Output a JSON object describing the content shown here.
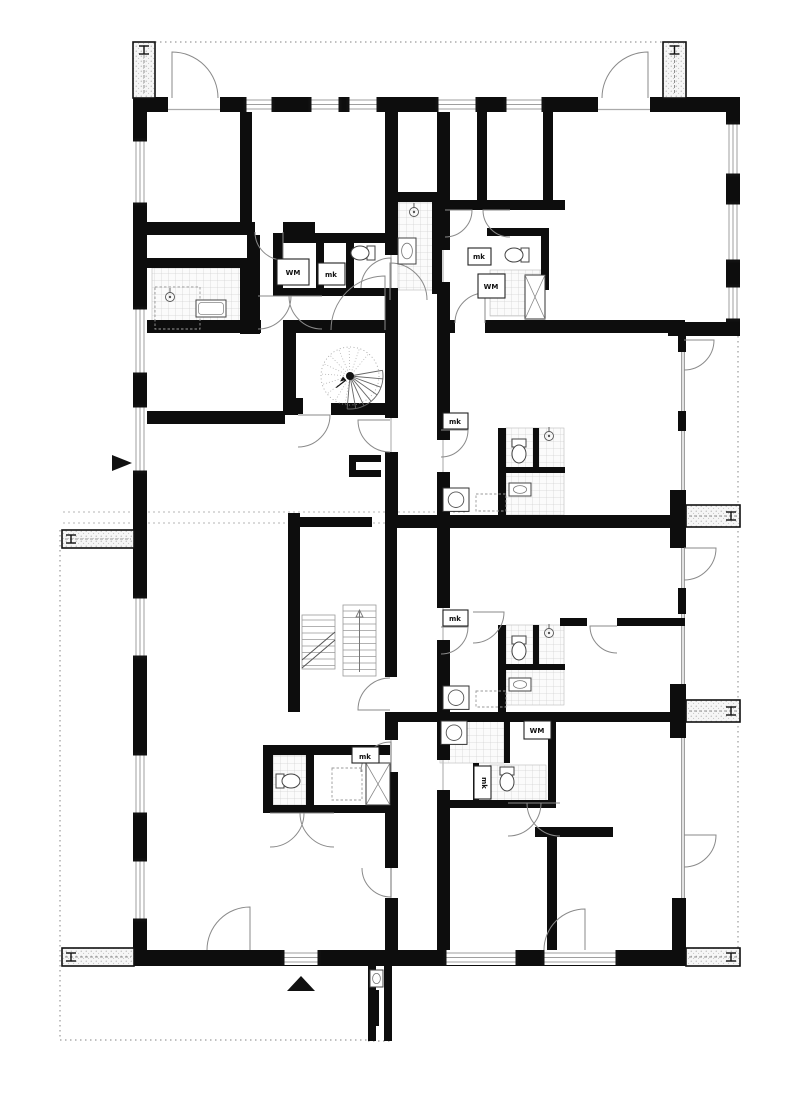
{
  "meta": {
    "drawing_type": "architectural floor plan",
    "bg_color": "#ffffff",
    "wall_color": "#0d0d0d",
    "thin_color": "#8a8a8a",
    "tile_line_color": "#c9c9c9",
    "tile_fill": "#fbfbfb",
    "dotted_color": "#9a9a9a"
  },
  "labels": [
    {
      "t": "WM",
      "x": 293,
      "y": 275,
      "box": [
        277,
        259,
        32,
        26
      ],
      "rot": 0
    },
    {
      "t": "mk",
      "x": 331,
      "y": 277,
      "box": [
        318,
        263,
        27,
        22
      ],
      "rot": 0
    },
    {
      "t": "mk",
      "x": 479,
      "y": 259,
      "box": [
        468,
        248,
        23,
        17
      ],
      "rot": 0
    },
    {
      "t": "WM",
      "x": 491,
      "y": 289,
      "box": [
        478,
        274,
        27,
        24
      ],
      "rot": 0
    },
    {
      "t": "mk",
      "x": 455,
      "y": 424,
      "box": [
        443,
        413,
        25,
        16
      ],
      "rot": 0
    },
    {
      "t": "mk",
      "x": 455,
      "y": 621,
      "box": [
        443,
        610,
        25,
        16
      ],
      "rot": 0
    },
    {
      "t": "mk",
      "x": 365,
      "y": 759,
      "box": [
        352,
        747,
        27,
        16
      ],
      "rot": 0
    },
    {
      "t": "WM",
      "x": 537,
      "y": 733,
      "box": [
        524,
        721,
        27,
        18
      ],
      "rot": 0
    },
    {
      "t": "mk",
      "x": 482,
      "y": 783,
      "box": [
        474,
        766,
        17,
        33
      ],
      "rot": 90
    }
  ],
  "walls": [
    [
      133,
      97,
      607,
      15
    ],
    [
      133,
      97,
      14,
      869
    ],
    [
      726,
      97,
      14,
      239
    ],
    [
      668,
      322,
      72,
      14
    ],
    [
      133,
      950,
      552,
      16
    ],
    [
      672,
      898,
      14,
      68
    ],
    [
      678,
      336,
      8,
      16
    ],
    [
      678,
      411,
      8,
      20
    ],
    [
      670,
      490,
      16,
      58
    ],
    [
      678,
      588,
      8,
      26
    ],
    [
      670,
      684,
      16,
      54
    ],
    [
      385,
      112,
      13,
      143
    ],
    [
      385,
      288,
      13,
      130
    ],
    [
      385,
      452,
      13,
      63
    ],
    [
      385,
      712,
      13,
      28
    ],
    [
      385,
      772,
      13,
      96
    ],
    [
      385,
      898,
      13,
      52
    ],
    [
      288,
      513,
      12,
      199
    ],
    [
      300,
      517,
      72,
      10
    ],
    [
      385,
      513,
      12,
      164
    ],
    [
      437,
      112,
      13,
      138
    ],
    [
      437,
      282,
      13,
      158
    ],
    [
      437,
      472,
      13,
      136
    ],
    [
      437,
      640,
      13,
      77
    ],
    [
      437,
      717,
      13,
      43
    ],
    [
      437,
      790,
      13,
      160
    ],
    [
      240,
      112,
      12,
      112
    ],
    [
      133,
      222,
      122,
      13
    ],
    [
      283,
      222,
      32,
      13
    ],
    [
      247,
      235,
      13,
      99
    ],
    [
      133,
      320,
      128,
      13
    ],
    [
      273,
      233,
      114,
      10
    ],
    [
      273,
      243,
      10,
      50
    ],
    [
      316,
      243,
      8,
      50
    ],
    [
      346,
      243,
      8,
      50
    ],
    [
      273,
      288,
      114,
      8
    ],
    [
      147,
      258,
      98,
      10
    ],
    [
      240,
      258,
      13,
      76
    ],
    [
      390,
      192,
      57,
      10
    ],
    [
      432,
      202,
      10,
      92
    ],
    [
      487,
      228,
      62,
      8
    ],
    [
      477,
      112,
      10,
      92
    ],
    [
      543,
      112,
      10,
      92
    ],
    [
      437,
      200,
      128,
      10
    ],
    [
      541,
      228,
      8,
      62
    ],
    [
      437,
      320,
      18,
      13
    ],
    [
      485,
      320,
      200,
      13
    ],
    [
      498,
      428,
      8,
      90
    ],
    [
      533,
      428,
      6,
      44
    ],
    [
      505,
      467,
      60,
      6
    ],
    [
      385,
      515,
      300,
      13
    ],
    [
      498,
      625,
      8,
      87
    ],
    [
      533,
      625,
      6,
      44
    ],
    [
      505,
      664,
      60,
      6
    ],
    [
      560,
      618,
      27,
      8
    ],
    [
      617,
      618,
      68,
      8
    ],
    [
      385,
      712,
      300,
      10
    ],
    [
      548,
      717,
      8,
      88
    ],
    [
      504,
      717,
      6,
      46
    ],
    [
      473,
      763,
      6,
      42
    ],
    [
      441,
      800,
      115,
      8
    ],
    [
      535,
      827,
      78,
      10
    ],
    [
      547,
      837,
      10,
      115
    ],
    [
      263,
      745,
      127,
      10
    ],
    [
      263,
      745,
      10,
      68
    ],
    [
      263,
      805,
      127,
      8
    ],
    [
      306,
      755,
      8,
      50
    ],
    [
      283,
      320,
      109,
      13
    ],
    [
      283,
      320,
      13,
      95
    ],
    [
      331,
      403,
      61,
      12
    ],
    [
      283,
      402,
      15,
      13
    ],
    [
      147,
      411,
      138,
      13
    ],
    [
      283,
      398,
      20,
      16
    ],
    [
      349,
      455,
      32,
      7
    ],
    [
      349,
      455,
      7,
      22
    ],
    [
      349,
      470,
      32,
      7
    ],
    [
      368,
      965,
      8,
      76
    ],
    [
      384,
      965,
      8,
      76
    ],
    [
      371,
      990,
      8,
      36
    ]
  ],
  "windows_h": [
    {
      "x": 245,
      "y": 97,
      "len": 28
    },
    {
      "x": 310,
      "y": 97,
      "len": 30
    },
    {
      "x": 348,
      "y": 97,
      "len": 30
    },
    {
      "x": 437,
      "y": 97,
      "len": 40
    },
    {
      "x": 505,
      "y": 97,
      "len": 38
    },
    {
      "x": 283,
      "y": 950,
      "len": 36
    },
    {
      "x": 445,
      "y": 950,
      "len": 72
    },
    {
      "x": 543,
      "y": 950,
      "len": 74
    }
  ],
  "windows_v": [
    {
      "x": 133,
      "y": 140,
      "len": 64
    },
    {
      "x": 133,
      "y": 308,
      "len": 66
    },
    {
      "x": 133,
      "y": 406,
      "len": 66
    },
    {
      "x": 133,
      "y": 597,
      "len": 60
    },
    {
      "x": 133,
      "y": 754,
      "len": 60
    },
    {
      "x": 133,
      "y": 860,
      "len": 60
    },
    {
      "x": 726,
      "y": 123,
      "len": 52
    },
    {
      "x": 726,
      "y": 203,
      "len": 58
    },
    {
      "x": 726,
      "y": 286,
      "len": 34
    }
  ],
  "openings_h": [
    {
      "x": 168,
      "y": 97,
      "len": 52
    },
    {
      "x": 598,
      "y": 97,
      "len": 52
    }
  ],
  "glazing": [
    [
      683,
      336,
      683,
      950
    ]
  ],
  "dotted": [
    [
      135,
      42,
      663,
      42
    ],
    [
      60,
      530,
      60,
      1040
    ],
    [
      60,
      1040,
      368,
      1040
    ],
    [
      738,
      336,
      738,
      962
    ],
    [
      368,
      1041,
      392,
      1041
    ]
  ],
  "dashed_pair": [
    [
      63,
      512,
      468,
      512
    ],
    [
      63,
      523,
      468,
      523
    ]
  ],
  "thresholds": [
    [
      391,
      255,
      391,
      288
    ],
    [
      391,
      418,
      391,
      452
    ],
    [
      391,
      740,
      391,
      772
    ],
    [
      391,
      868,
      391,
      898
    ],
    [
      443,
      250,
      443,
      282
    ],
    [
      443,
      440,
      443,
      472
    ],
    [
      443,
      608,
      443,
      640
    ],
    [
      443,
      760,
      443,
      790
    ]
  ],
  "doors": [
    {
      "x": 172,
      "y": 98,
      "r": 46,
      "a0": 270,
      "a1": 360
    },
    {
      "x": 648,
      "y": 98,
      "r": 46,
      "a0": 270,
      "a1": 180
    },
    {
      "x": 283,
      "y": 232,
      "r": 28,
      "a0": 90,
      "a1": 180
    },
    {
      "x": 258,
      "y": 296,
      "r": 33,
      "a0": 0,
      "a1": 90
    },
    {
      "x": 322,
      "y": 296,
      "r": 33,
      "a0": 180,
      "a1": 90
    },
    {
      "x": 445,
      "y": 210,
      "r": 27,
      "a0": 0,
      "a1": 90
    },
    {
      "x": 510,
      "y": 210,
      "r": 27,
      "a0": 180,
      "a1": 90
    },
    {
      "x": 390,
      "y": 300,
      "r": 37,
      "a0": 270,
      "a1": 360
    },
    {
      "x": 385,
      "y": 330,
      "r": 54,
      "a0": 270,
      "a1": 180
    },
    {
      "x": 485,
      "y": 323,
      "r": 30,
      "a0": 270,
      "a1": 180
    },
    {
      "x": 684,
      "y": 548,
      "r": 32,
      "a0": 0,
      "a1": 90
    },
    {
      "x": 684,
      "y": 340,
      "r": 30,
      "a0": 0,
      "a1": 90
    },
    {
      "x": 684,
      "y": 835,
      "r": 32,
      "a0": 0,
      "a1": 90
    },
    {
      "x": 473,
      "y": 612,
      "r": 31,
      "a0": 0,
      "a1": 90
    },
    {
      "x": 617,
      "y": 626,
      "r": 27,
      "a0": 180,
      "a1": 90
    },
    {
      "x": 390,
      "y": 710,
      "r": 32,
      "a0": 180,
      "a1": 270
    },
    {
      "x": 391,
      "y": 772,
      "r": 30,
      "a0": 270,
      "a1": 180
    },
    {
      "x": 270,
      "y": 813,
      "r": 34,
      "a0": 0,
      "a1": 90
    },
    {
      "x": 334,
      "y": 813,
      "r": 34,
      "a0": 180,
      "a1": 90
    },
    {
      "x": 391,
      "y": 868,
      "r": 29,
      "a0": 90,
      "a1": 180
    },
    {
      "x": 508,
      "y": 803,
      "r": 33,
      "a0": 0,
      "a1": 90
    },
    {
      "x": 560,
      "y": 803,
      "r": 33,
      "a0": 180,
      "a1": 90
    },
    {
      "x": 250,
      "y": 950,
      "r": 43,
      "a0": 270,
      "a1": 180
    },
    {
      "x": 585,
      "y": 950,
      "r": 41,
      "a0": 270,
      "a1": 180
    },
    {
      "x": 298,
      "y": 415,
      "r": 32,
      "a0": 0,
      "a1": 90
    },
    {
      "x": 390,
      "y": 420,
      "r": 32,
      "a0": 180,
      "a1": 90
    },
    {
      "x": 441,
      "y": 430,
      "r": 27,
      "a0": 0,
      "a1": 90
    },
    {
      "x": 391,
      "y": 288,
      "r": 30,
      "a0": 270,
      "a1": 180
    },
    {
      "x": 441,
      "y": 627,
      "r": 27,
      "a0": 0,
      "a1": 90
    }
  ],
  "tiles": [
    [
      152,
      268,
      95,
      62
    ],
    [
      398,
      202,
      36,
      88
    ],
    [
      490,
      270,
      51,
      46
    ],
    [
      506,
      428,
      58,
      87
    ],
    [
      506,
      625,
      58,
      80
    ],
    [
      440,
      719,
      64,
      44
    ],
    [
      490,
      765,
      56,
      36
    ],
    [
      273,
      755,
      33,
      50
    ]
  ],
  "dashed_boxes": [
    [
      476,
      494,
      30,
      17
    ],
    [
      476,
      691,
      30,
      16
    ],
    [
      332,
      768,
      30,
      32
    ],
    [
      155,
      287,
      45,
      42
    ]
  ],
  "machines": [
    [
      443,
      488,
      26
    ],
    [
      443,
      686,
      26
    ],
    [
      441,
      721,
      26
    ]
  ],
  "basins": [
    [
      398,
      238,
      18,
      26
    ],
    [
      509,
      483,
      22,
      13
    ],
    [
      509,
      678,
      22,
      13
    ],
    [
      370,
      970,
      13,
      17
    ]
  ],
  "bathtub": [
    196,
    300,
    30,
    17
  ],
  "toilets": [
    {
      "x": 362,
      "y": 253,
      "dir": "left"
    },
    {
      "x": 516,
      "y": 255,
      "dir": "left"
    },
    {
      "x": 519,
      "y": 452,
      "dir": "down"
    },
    {
      "x": 519,
      "y": 649,
      "dir": "down"
    },
    {
      "x": 507,
      "y": 780,
      "dir": "down"
    },
    {
      "x": 289,
      "y": 781,
      "dir": "right"
    }
  ],
  "showers": [
    [
      549,
      436
    ],
    [
      549,
      633
    ],
    [
      414,
      212
    ],
    [
      170,
      297
    ]
  ],
  "xbraces": [
    [
      366,
      763,
      24,
      42
    ],
    [
      525,
      275,
      20,
      44
    ],
    [
      408,
      548,
      0,
      0
    ]
  ],
  "dividers": [
    {
      "x": 133,
      "y": 42,
      "w": 22,
      "h": 56,
      "end": "top"
    },
    {
      "x": 663,
      "y": 42,
      "w": 23,
      "h": 56,
      "end": "top"
    },
    {
      "x": 62,
      "y": 530,
      "w": 72,
      "h": 18,
      "end": "left"
    },
    {
      "x": 62,
      "y": 948,
      "w": 72,
      "h": 18,
      "end": "left"
    },
    {
      "x": 686,
      "y": 505,
      "w": 54,
      "h": 22,
      "end": "right"
    },
    {
      "x": 686,
      "y": 700,
      "w": 54,
      "h": 22,
      "end": "right"
    },
    {
      "x": 686,
      "y": 948,
      "w": 54,
      "h": 18,
      "end": "right"
    }
  ],
  "spiral_stair": {
    "cx": 350,
    "cy": 376,
    "r": 29
  },
  "straight_stair": {
    "x": 302,
    "y": 560,
    "w": 76,
    "h": 116
  },
  "north_arrow": {
    "x": 301,
    "y": 984
  },
  "section_marker": {
    "x": 121,
    "y": 463
  }
}
